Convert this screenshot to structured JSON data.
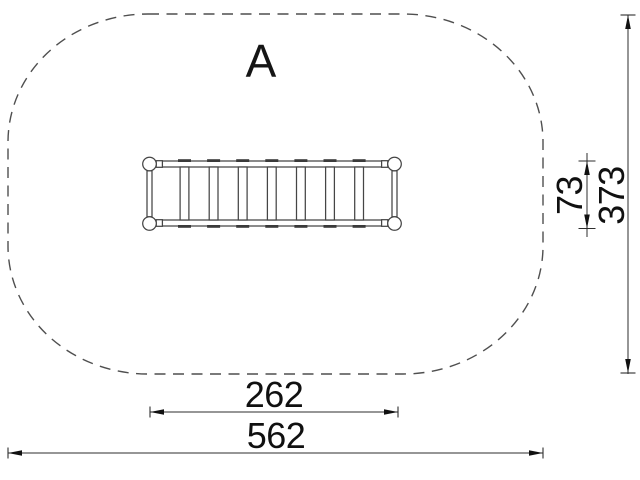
{
  "drawing": {
    "type": "playground-equipment-plan-view",
    "view_label": "A",
    "dimensions": {
      "equipment_length": "262",
      "safety_zone_length": "562",
      "equipment_width": "73",
      "safety_zone_width": "373"
    },
    "colors": {
      "background": "#ffffff",
      "structure_line": "#454545",
      "dimension_line": "#2e2e2e",
      "text": "#101010",
      "safety_zone_dash": "#4f4f4f"
    }
  }
}
